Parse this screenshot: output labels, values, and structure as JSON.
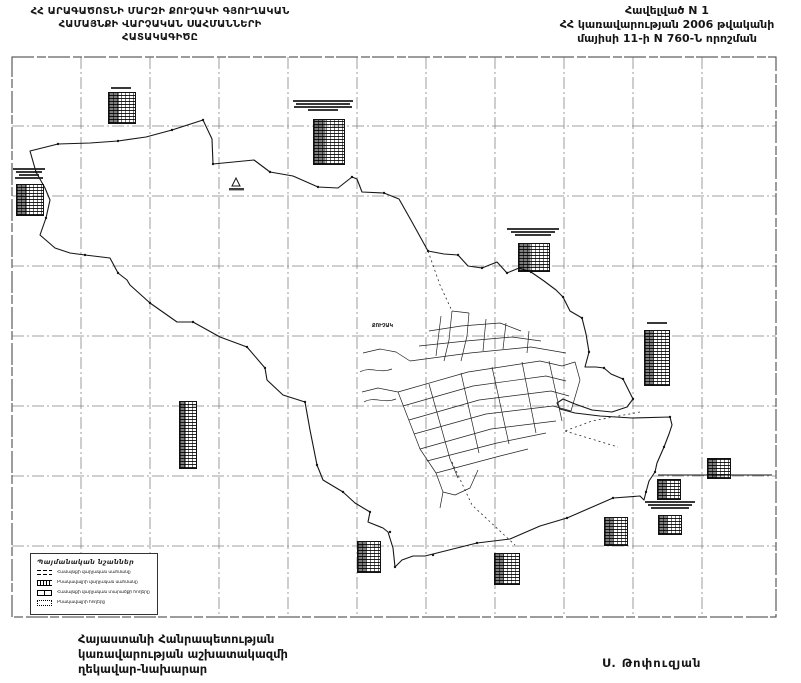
{
  "header": {
    "left_title": {
      "line1": "ՀՀ ԱՐԱԳԱԾՈՏՆԻ ՄԱՐԶԻ ՔՈՒՉԱԿԻ ԳՅՈՒՂԱԿԱՆ",
      "line2": "ՀԱՄԱՅՆՔԻ ՎԱՐՉԱԿԱՆ ՍԱՀՄԱՆՆԵՐԻ",
      "line3": "ՀԱՏԱԿԱԳԻԾԸ"
    },
    "right_title": {
      "line1": "Հավելված N 1",
      "line2": "ՀՀ կառավարության 2006 թվականի",
      "line3": "մայիսի 11-ի N 760-Ն որոշման"
    }
  },
  "map": {
    "village_label": "ՔՈՒՉԱԿ"
  },
  "legend": {
    "title": "Պայմանական նշաններ",
    "items": [
      {
        "label": "Համայնքի վարչական սահմանը"
      },
      {
        "label": "Բնակավայրի վարչական սահմանը"
      },
      {
        "label": "Համայնքի վարչական տարածքի հողերը"
      },
      {
        "label": "Բնակավայրի հողերը"
      }
    ]
  },
  "footer": {
    "line1": "Հայաստանի Հանրապետության",
    "line2": "կառավարության աշխատակազմի",
    "line3": "ղեկավար-նախարար",
    "signature": "Ս. Թոփուզյան"
  },
  "colors": {
    "ink": "#1b1b1b",
    "grid": "#6e6e6e",
    "paper": "#ffffff"
  }
}
